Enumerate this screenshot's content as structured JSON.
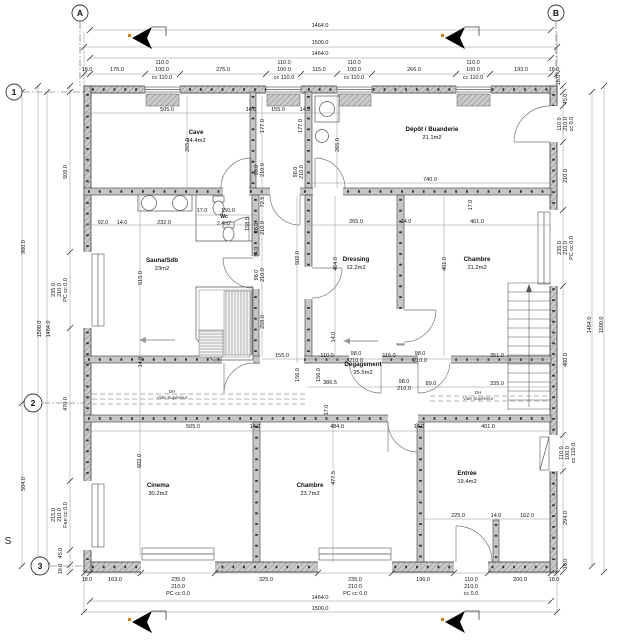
{
  "compass": {
    "label": "S",
    "x": 8,
    "y": 544
  },
  "grid_markers": [
    {
      "label": "A",
      "x": 80,
      "y": 13,
      "r": 8
    },
    {
      "label": "B",
      "x": 556,
      "y": 13,
      "r": 8
    },
    {
      "label": "1",
      "x": 14,
      "y": 92,
      "r": 8
    },
    {
      "label": "2",
      "x": 33,
      "y": 403,
      "r": 9
    },
    {
      "label": "3",
      "x": 40,
      "y": 566,
      "r": 9
    }
  ],
  "rooms": [
    {
      "name": "Cave",
      "area": "14.4m2",
      "x": 196,
      "y": 134
    },
    {
      "name": "Dépôt / Buanderie",
      "area": "21.1m2",
      "x": 432,
      "y": 131
    },
    {
      "name": "Wc",
      "area": "2.4m2",
      "x": 224,
      "y": 218,
      "small": true
    },
    {
      "name": "Sauna/Sdb",
      "area": "23m2",
      "x": 162,
      "y": 262
    },
    {
      "name": "Dressing",
      "area": "12.2m2",
      "x": 356,
      "y": 261
    },
    {
      "name": "Chambre",
      "area": "21.2m2",
      "x": 477,
      "y": 261
    },
    {
      "name": "Dégagement",
      "area": "25.5m2",
      "x": 363,
      "y": 366
    },
    {
      "name": "Cinema",
      "area": "30.2m2",
      "x": 158,
      "y": 487
    },
    {
      "name": "Chambre",
      "area": "23.7m2",
      "x": 310,
      "y": 487
    },
    {
      "name": "Entrée",
      "area": "19.4m2",
      "x": 467,
      "y": 475
    }
  ],
  "annotations": [
    {
      "line1": "DH",
      "line2": "Vide Supérieur",
      "x": 172,
      "y": 393
    },
    {
      "line1": "DH",
      "line2": "Vide Supérieur",
      "x": 478,
      "y": 394
    }
  ],
  "dim_labels": [
    {
      "t": "1464.0",
      "x": 320,
      "y": 27
    },
    {
      "t": "1500.0",
      "x": 320,
      "y": 44
    },
    {
      "t": "1464.0",
      "x": 320,
      "y": 55
    },
    {
      "t": "18.0",
      "x": 87,
      "y": 71
    },
    {
      "t": "175.0",
      "x": 117,
      "y": 71
    },
    {
      "t": "110.0",
      "x": 162,
      "y": 64
    },
    {
      "t": "100.0",
      "x": 162,
      "y": 71
    },
    {
      "t": "cc 110.0",
      "x": 162,
      "y": 79
    },
    {
      "t": "275.0",
      "x": 223,
      "y": 71
    },
    {
      "t": "110.0",
      "x": 284,
      "y": 64
    },
    {
      "t": "100.0",
      "x": 284,
      "y": 71
    },
    {
      "t": "cc 110.0",
      "x": 284,
      "y": 79
    },
    {
      "t": "115.0",
      "x": 319,
      "y": 71
    },
    {
      "t": "110.0",
      "x": 354,
      "y": 64
    },
    {
      "t": "100.0",
      "x": 354,
      "y": 71
    },
    {
      "t": "cc 110.0",
      "x": 354,
      "y": 79
    },
    {
      "t": "266.0",
      "x": 414,
      "y": 71
    },
    {
      "t": "110.0",
      "x": 473,
      "y": 64
    },
    {
      "t": "100.0",
      "x": 473,
      "y": 71
    },
    {
      "t": "cc 110.0",
      "x": 473,
      "y": 79
    },
    {
      "t": "193.0",
      "x": 521,
      "y": 71
    },
    {
      "t": "18.0",
      "x": 554,
      "y": 71
    },
    {
      "t": "18.0",
      "x": 87,
      "y": 581
    },
    {
      "t": "163.0",
      "x": 115,
      "y": 581
    },
    {
      "t": "235.0",
      "x": 178,
      "y": 581
    },
    {
      "t": "210.0",
      "x": 178,
      "y": 588
    },
    {
      "t": "PC cc 0.0",
      "x": 178,
      "y": 595
    },
    {
      "t": "325.0",
      "x": 266,
      "y": 581
    },
    {
      "t": "235.0",
      "x": 355,
      "y": 581
    },
    {
      "t": "210.0",
      "x": 355,
      "y": 588
    },
    {
      "t": "PC cc 0.0",
      "x": 355,
      "y": 595
    },
    {
      "t": "196.0",
      "x": 423,
      "y": 581
    },
    {
      "t": "110.0",
      "x": 471,
      "y": 581
    },
    {
      "t": "210.0",
      "x": 471,
      "y": 588
    },
    {
      "t": "cc 0.0",
      "x": 471,
      "y": 595
    },
    {
      "t": "200.0",
      "x": 520,
      "y": 581
    },
    {
      "t": "18.0",
      "x": 554,
      "y": 581
    },
    {
      "t": "1464.0",
      "x": 320,
      "y": 599
    },
    {
      "t": "1500.0",
      "x": 320,
      "y": 610
    },
    {
      "t": "960.0",
      "x": 25,
      "y": 247,
      "r": 1
    },
    {
      "t": "504.0",
      "x": 25,
      "y": 484,
      "r": 1
    },
    {
      "t": "1500.0",
      "x": 41,
      "y": 329,
      "r": 1
    },
    {
      "t": "1464.0",
      "x": 50,
      "y": 329,
      "r": 1
    },
    {
      "t": "509.0",
      "x": 67,
      "y": 172,
      "r": 1
    },
    {
      "t": "235.0",
      "x": 55,
      "y": 290,
      "r": 1
    },
    {
      "t": "210.0",
      "x": 61,
      "y": 290,
      "r": 1
    },
    {
      "t": "PC cc 0.0",
      "x": 67,
      "y": 290,
      "r": 1
    },
    {
      "t": "470.0",
      "x": 67,
      "y": 404,
      "r": 1
    },
    {
      "t": "215.0",
      "x": 55,
      "y": 515,
      "r": 1
    },
    {
      "t": "210.0",
      "x": 61,
      "y": 515,
      "r": 1
    },
    {
      "t": "Fen cc 0.0",
      "x": 67,
      "y": 515,
      "r": 1
    },
    {
      "t": "45.0",
      "x": 62,
      "y": 553,
      "r": 1
    },
    {
      "t": "18.0",
      "x": 62,
      "y": 569,
      "r": 1
    },
    {
      "t": "18.0",
      "x": 560,
      "y": 80,
      "r": 1
    },
    {
      "t": "45.0",
      "x": 567,
      "y": 99,
      "r": 1
    },
    {
      "t": "110.0",
      "x": 561,
      "y": 124,
      "r": 1
    },
    {
      "t": "210.0",
      "x": 567,
      "y": 124,
      "r": 1
    },
    {
      "t": "cc 0.0",
      "x": 573,
      "y": 124,
      "r": 1
    },
    {
      "t": "210.0",
      "x": 567,
      "y": 176,
      "r": 1
    },
    {
      "t": "235.0",
      "x": 561,
      "y": 248,
      "r": 1
    },
    {
      "t": "210.0",
      "x": 567,
      "y": 248,
      "r": 1
    },
    {
      "t": "PC cc 0.0",
      "x": 573,
      "y": 248,
      "r": 1
    },
    {
      "t": "460.0",
      "x": 567,
      "y": 360,
      "r": 1
    },
    {
      "t": "110.0",
      "x": 563,
      "y": 453,
      "r": 1
    },
    {
      "t": "100.0",
      "x": 569,
      "y": 453,
      "r": 1
    },
    {
      "t": "cc 110.0",
      "x": 575,
      "y": 453,
      "r": 1
    },
    {
      "t": "294.0",
      "x": 567,
      "y": 518,
      "r": 1
    },
    {
      "t": "18.0",
      "x": 567,
      "y": 564,
      "r": 1
    },
    {
      "t": "1464.0",
      "x": 591,
      "y": 325,
      "r": 1
    },
    {
      "t": "1500.0",
      "x": 603,
      "y": 325,
      "r": 1
    },
    {
      "t": "505.0",
      "x": 167,
      "y": 111
    },
    {
      "t": "14.0",
      "x": 251,
      "y": 111
    },
    {
      "t": "155.0",
      "x": 278,
      "y": 111
    },
    {
      "t": "14.0",
      "x": 305,
      "y": 111
    },
    {
      "t": "177.0",
      "x": 264,
      "y": 126,
      "r": 1
    },
    {
      "t": "177.0",
      "x": 302,
      "y": 126,
      "r": 1
    },
    {
      "t": "265.0",
      "x": 189,
      "y": 145,
      "r": 1
    },
    {
      "t": "265.0",
      "x": 339,
      "y": 145,
      "r": 1
    },
    {
      "t": "98.0",
      "x": 258,
      "y": 170,
      "r": 1
    },
    {
      "t": "210.0",
      "x": 264,
      "y": 170,
      "r": 1
    },
    {
      "t": "98.0",
      "x": 297,
      "y": 172,
      "r": 1
    },
    {
      "t": "210.0",
      "x": 303,
      "y": 172,
      "r": 1
    },
    {
      "t": "740.0",
      "x": 430,
      "y": 181
    },
    {
      "t": "92.0",
      "x": 103,
      "y": 224
    },
    {
      "t": "14.0",
      "x": 122,
      "y": 224
    },
    {
      "t": "232.0",
      "x": 164,
      "y": 224
    },
    {
      "t": "17.0",
      "x": 202,
      "y": 212
    },
    {
      "t": "150.0",
      "x": 228,
      "y": 212
    },
    {
      "t": "158.5",
      "x": 249,
      "y": 224,
      "r": 1
    },
    {
      "t": "72.5",
      "x": 264,
      "y": 202,
      "r": 1
    },
    {
      "t": "98.0",
      "x": 258,
      "y": 228,
      "r": 1
    },
    {
      "t": "210.0",
      "x": 264,
      "y": 228,
      "r": 1
    },
    {
      "t": "265.0",
      "x": 356,
      "y": 223
    },
    {
      "t": "14.0",
      "x": 406,
      "y": 223
    },
    {
      "t": "461.0",
      "x": 477,
      "y": 223
    },
    {
      "t": "17.0",
      "x": 472,
      "y": 205,
      "r": 1
    },
    {
      "t": "34.0",
      "x": 258,
      "y": 252,
      "r": 1
    },
    {
      "t": "98.0",
      "x": 258,
      "y": 275,
      "r": 1
    },
    {
      "t": "210.0",
      "x": 264,
      "y": 275,
      "r": 1
    },
    {
      "t": "259.0",
      "x": 264,
      "y": 322,
      "r": 1
    },
    {
      "t": "515.0",
      "x": 142,
      "y": 278,
      "r": 1
    },
    {
      "t": "14.0",
      "x": 142,
      "y": 362,
      "r": 1
    },
    {
      "t": "502.0",
      "x": 299,
      "y": 258,
      "r": 1
    },
    {
      "t": "464.0",
      "x": 337,
      "y": 264,
      "r": 1
    },
    {
      "t": "461.0",
      "x": 446,
      "y": 264,
      "r": 1
    },
    {
      "t": "14.0",
      "x": 335,
      "y": 337,
      "r": 1
    },
    {
      "t": "155.0",
      "x": 282,
      "y": 357
    },
    {
      "t": "110.0",
      "x": 327,
      "y": 357
    },
    {
      "t": "98.0",
      "x": 356,
      "y": 355
    },
    {
      "t": "210.0",
      "x": 356,
      "y": 362
    },
    {
      "t": "115.0",
      "x": 389,
      "y": 357
    },
    {
      "t": "98.0",
      "x": 420,
      "y": 355
    },
    {
      "t": "210.0",
      "x": 420,
      "y": 362
    },
    {
      "t": "351.0",
      "x": 497,
      "y": 357
    },
    {
      "t": "156.0",
      "x": 299,
      "y": 375,
      "r": 1
    },
    {
      "t": "156.0",
      "x": 320,
      "y": 375,
      "r": 1
    },
    {
      "t": "386.5",
      "x": 330,
      "y": 384
    },
    {
      "t": "98.0",
      "x": 404,
      "y": 383
    },
    {
      "t": "210.0",
      "x": 404,
      "y": 390
    },
    {
      "t": "89.0",
      "x": 431,
      "y": 385
    },
    {
      "t": "335.0",
      "x": 497,
      "y": 385
    },
    {
      "t": "17.0",
      "x": 328,
      "y": 410,
      "r": 1
    },
    {
      "t": "505.0",
      "x": 193,
      "y": 428
    },
    {
      "t": "14.0",
      "x": 255,
      "y": 428
    },
    {
      "t": "484.0",
      "x": 337,
      "y": 428
    },
    {
      "t": "14.0",
      "x": 419,
      "y": 428
    },
    {
      "t": "401.0",
      "x": 488,
      "y": 428
    },
    {
      "t": "602.0",
      "x": 141,
      "y": 461,
      "r": 1
    },
    {
      "t": "477.5",
      "x": 335,
      "y": 478,
      "r": 1
    },
    {
      "t": "225.0",
      "x": 458,
      "y": 517
    },
    {
      "t": "14.0",
      "x": 496,
      "y": 517
    },
    {
      "t": "162.0",
      "x": 527,
      "y": 517
    }
  ]
}
